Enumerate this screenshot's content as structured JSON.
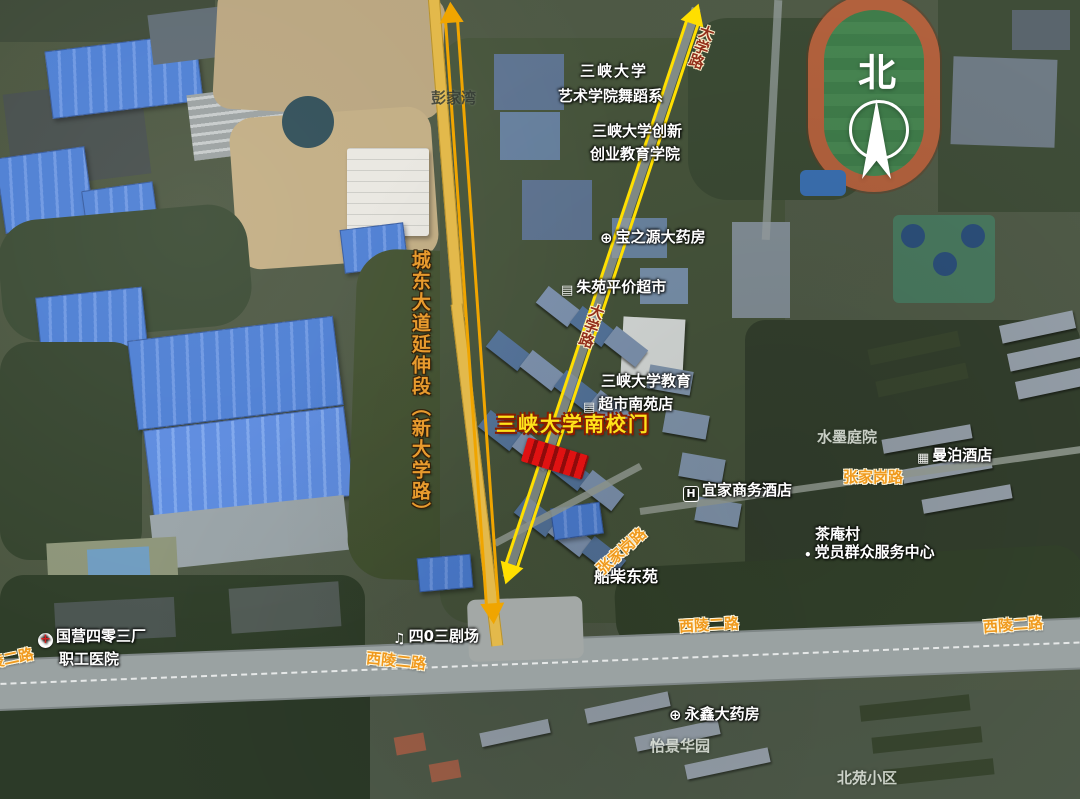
{
  "compass": {
    "north": "北"
  },
  "arrows": {
    "left_color": "#f0a500",
    "right_color": "#ffdf00"
  },
  "annotations": {
    "road_extension": "城东大道延伸段（新大学路）",
    "south_gate": "三峡大学南校门",
    "daxue_road_top": "大学路",
    "daxue_road_mid": "大学路"
  },
  "pois": {
    "art_college_line1": "三峡大学",
    "art_college_line2": "艺术学院舞蹈系",
    "innovation_line1": "三峡大学创新",
    "innovation_line2": "创业教育学院",
    "pharmacy_baozhiyuan": "宝之源大药房",
    "supermarket_zhuyuan": "朱苑平价超市",
    "edu_supermarket_line1": "三峡大学教育",
    "edu_supermarket_line2": "超市南苑店",
    "hotel_yijia": "宜家商务酒店",
    "shuimo_courtyard": "水墨庭院",
    "hotel_manbo": "曼泊酒店",
    "chaan_village_line1": "茶庵村",
    "chaan_village_line2": "党员群众服务中心",
    "chuanchai_dongyuan": "船柴东苑",
    "theater_403": "四0三剧场",
    "hospital_line1": "国营四零三厂",
    "hospital_line2": "职工医院",
    "pharmacy_yongxin": "永鑫大药房",
    "yijing_garden": "怡景华园",
    "beiyuan_community": "北苑小区",
    "pengjiawan": "彭家湾"
  },
  "road_labels": {
    "zhangjiagang_horizontal": "张家岗路",
    "zhangjiagang_diagonal": "张家岗路",
    "xiling_left_edge": "西陵二路",
    "xiling_left": "西陵二路",
    "xiling_center": "西陵二路",
    "xiling_right": "西陵二路"
  },
  "icons": {
    "pharmacy": "⊕",
    "hospital_cross": "+",
    "hotel_h": "H",
    "building": "▦",
    "supermarket": "▤",
    "music_note": "♫",
    "dot": "•"
  }
}
